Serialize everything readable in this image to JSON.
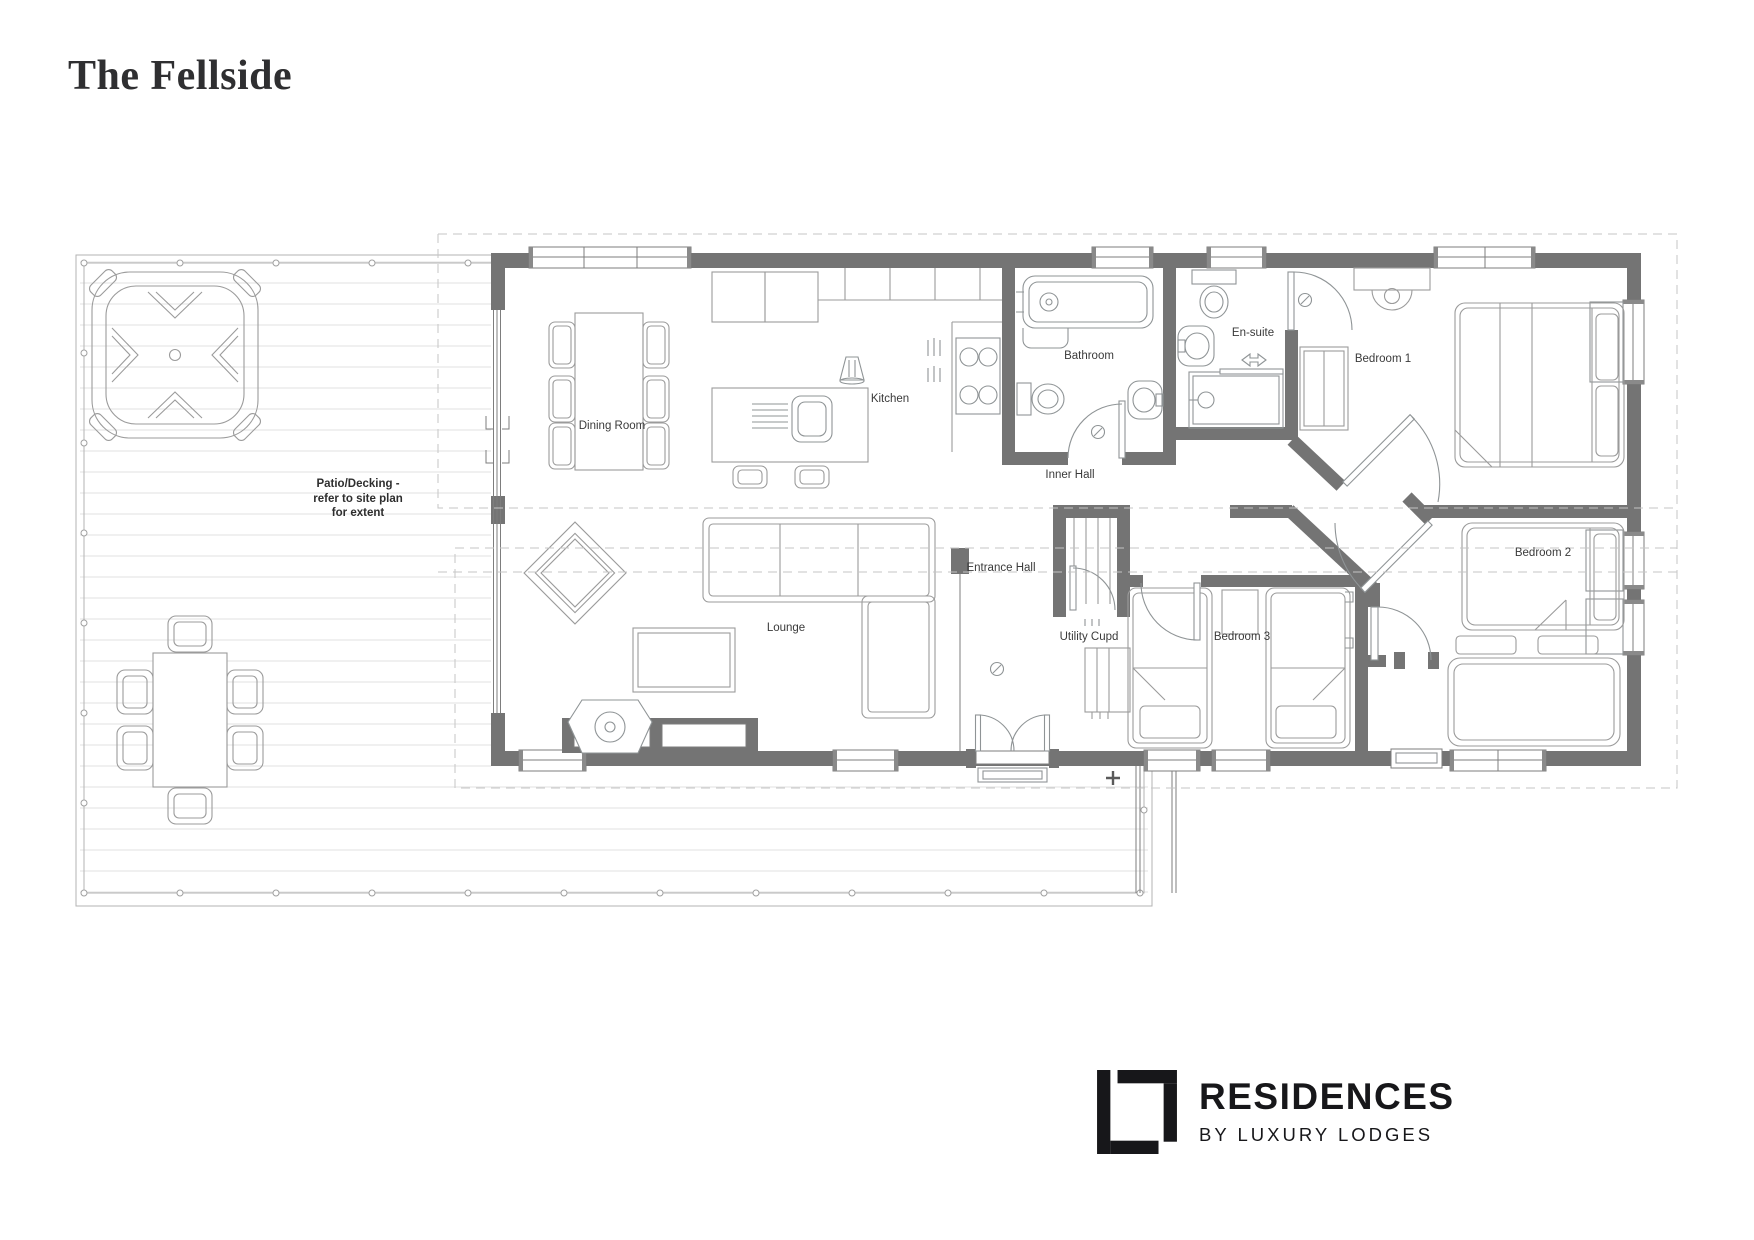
{
  "page": {
    "title": "The Fellside",
    "background": "#ffffff"
  },
  "plan": {
    "rooms": {
      "dining": "Dining Room",
      "kitchen": "Kitchen",
      "bathroom": "Bathroom",
      "ensuite": "En-suite",
      "bedroom1": "Bedroom 1",
      "inner_hall": "Inner Hall",
      "entrance_hall": "Entrance Hall",
      "utility": "Utility Cupd",
      "bedroom3": "Bedroom 3",
      "bedroom2": "Bedroom 2",
      "lounge": "Lounge"
    },
    "patio_note": {
      "line1": "Patio/Decking -",
      "line2": "refer to site plan",
      "line3": "for extent"
    },
    "colors": {
      "wall": "#747474",
      "furniture": "#9b9b9b",
      "deck_board": "#e2e2e2",
      "dashed_boundary": "#c5c5c5",
      "label": "#3a3a3a",
      "logo": "#17171a"
    },
    "icons": [
      "hot-tub",
      "outdoor-dining-set",
      "dining-table",
      "kitchen-island",
      "hob",
      "cooker-hood",
      "bathtub",
      "toilet",
      "wash-basin",
      "shower-enclosure",
      "double-bed",
      "single-bed",
      "wardrobe",
      "bedside-shelf",
      "sofa",
      "armchair",
      "coffee-table",
      "wood-burning-stove",
      "media-wall",
      "utility-shelves",
      "nightstand",
      "bench-seat",
      "entrance-doors",
      "window",
      "decking-boards"
    ]
  },
  "logo": {
    "brand": "RESIDENCES",
    "tagline": "BY LUXURY LODGES",
    "icon": "luxury-lodges-monogram-icon"
  }
}
